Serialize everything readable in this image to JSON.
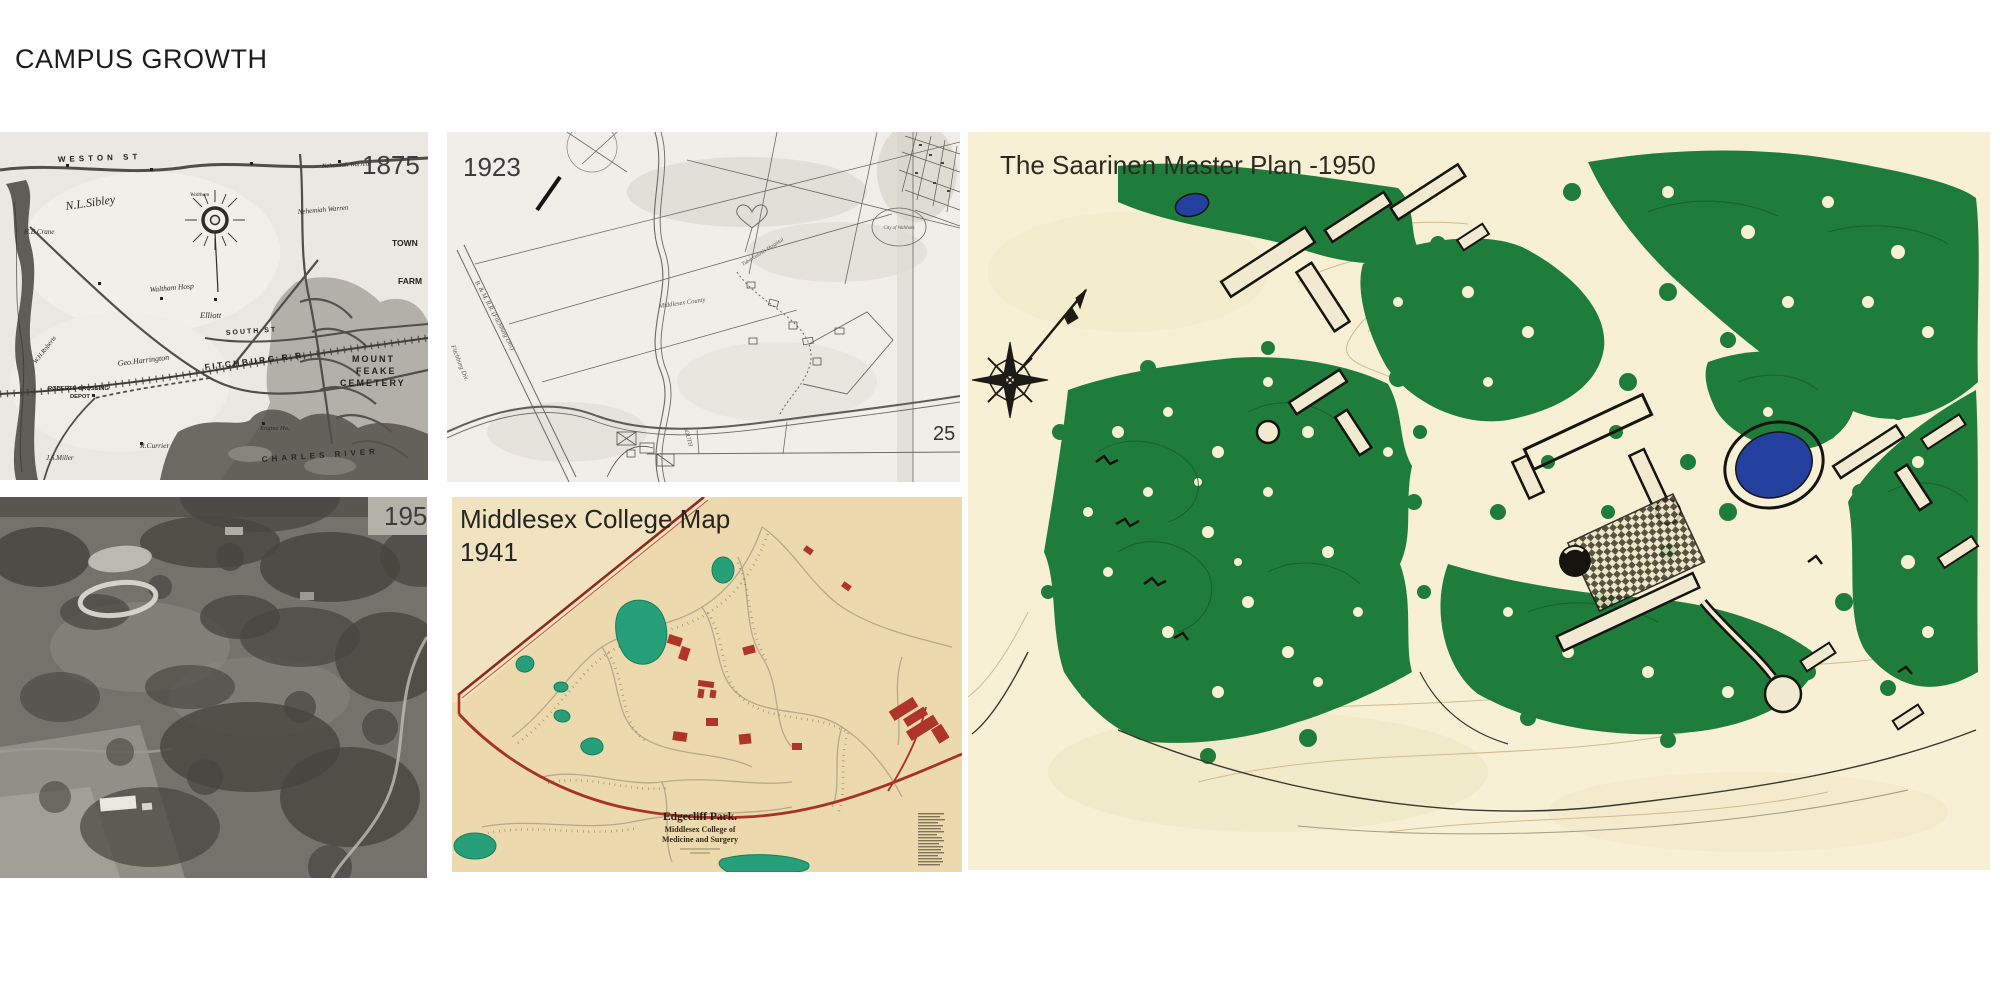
{
  "page": {
    "title": "CAMPUS GROWTH"
  },
  "map_1875": {
    "year": "1875",
    "labels": {
      "weston": "WESTON ST",
      "sibley": "N.L.Sibley",
      "crane": "H.B.Crane",
      "warren": "Nehemiah Warren",
      "hosp": "Waltham Hosp",
      "waltham": "Waltham",
      "elliott": "Elliott",
      "south": "SOUTH ST",
      "harrington": "Geo.Harrington",
      "roberts": "W.H.Roberts",
      "crossing1": "ROBERTS CROSSING",
      "crossing2": "DEPOT",
      "fitchburg": "FITCHBURG R.R.",
      "miller": "J.S.Miller",
      "currier": "R.Currier",
      "engine": "Engine Ho.",
      "town": "TOWN",
      "farm": "FARM",
      "mount": "MOUNT",
      "feake": "FEAKE",
      "cemetery": "CEMETERY",
      "river": "CHARLES RIVER"
    }
  },
  "map_1923": {
    "year": "1923",
    "page_number": "25",
    "labels": {
      "railroad": "B. & M. R.R. (Fitchburg Div.)",
      "fitchburg": "Fitchburg Div.",
      "south": "SOUTH",
      "county": "Middlesex County",
      "hospital": "Tuberculosis Hospital",
      "city": "City of Waltham"
    }
  },
  "photo_1950": {
    "year": "1950"
  },
  "map_1941": {
    "title_line1": "Middlesex College Map",
    "title_line2": "1941",
    "caption_title": "Edgecliff Park.",
    "caption_line2": "Middlesex College of",
    "caption_line3": "Medicine and Surgery"
  },
  "saarinen": {
    "title": "The Saarinen Master Plan -1950"
  },
  "colors": {
    "slide_bg": "#ffffff",
    "title_text": "#1c1c1c",
    "year_label": "#3c3c3c",
    "saarinen_bg": "#f7f0d4",
    "saarinen_green": "#1f7d3b",
    "saarinen_contour": "#cdbd90",
    "pond_navy": "#24409e",
    "middlesex_bg": "#ecd9ad",
    "middlesex_red": "#a93226",
    "pond_teal": "#27a079",
    "old_map_bg": "#eae8e2",
    "survey_map_bg": "#efeee9"
  }
}
